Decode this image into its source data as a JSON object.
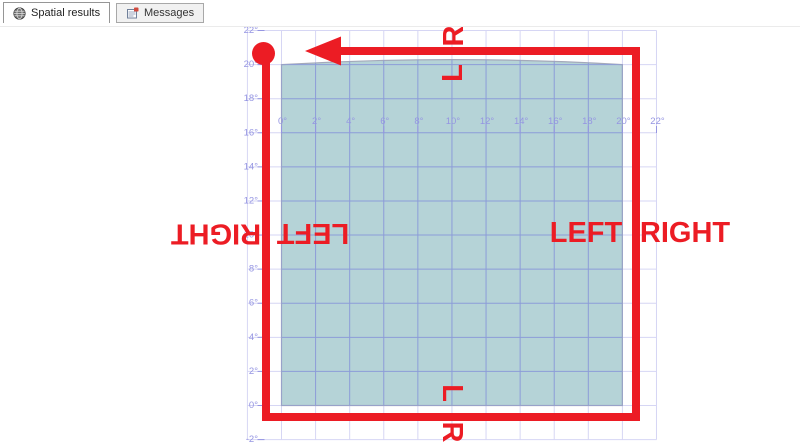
{
  "tabs": [
    {
      "label": "Spatial results",
      "icon": "globe-icon",
      "active": true
    },
    {
      "label": "Messages",
      "icon": "messages-icon",
      "active": false
    }
  ],
  "chart_data": {
    "type": "spatial-map",
    "title": "Spatial results grid with geography polygon ring and red direction annotations",
    "x_axis": {
      "labels": [
        "0°",
        "2°",
        "4°",
        "6°",
        "8°",
        "10°",
        "12°",
        "14°",
        "16°",
        "18°",
        "20°",
        "22°"
      ],
      "values": [
        0,
        2,
        4,
        6,
        8,
        10,
        12,
        14,
        16,
        18,
        20,
        22
      ]
    },
    "y_axis": {
      "labels": [
        "22°",
        "20°",
        "18°",
        "16°",
        "14°",
        "12°",
        "10°",
        "8°",
        "6°",
        "4°",
        "2°",
        "0°",
        "-2°"
      ],
      "values": [
        22,
        20,
        18,
        16,
        14,
        12,
        10,
        8,
        6,
        4,
        2,
        0,
        -2
      ]
    },
    "grid": {
      "on": true,
      "step_deg": 2,
      "range_deg": [
        -2,
        22
      ],
      "color_outside": "#d6d6f4",
      "color_inside": "#8c9cd8"
    },
    "axis_label_color": "#9595e2",
    "polygon": {
      "x_range_deg": [
        0,
        20
      ],
      "y_range_deg": [
        0,
        20
      ],
      "fill": "#b5d3d7",
      "stroke": "#a4a9ba",
      "top_edge": "slight upward arc"
    },
    "annotations": {
      "color": "#ec1c24",
      "direction": "counterclockwise ring, arrow points west along top edge",
      "labels": {
        "top_outside": "R",
        "top_inside": "L",
        "left_outside": "RIGHT",
        "left_inside": "LEFT",
        "right_inside": "LEFT",
        "right_outside": "RIGHT",
        "bottom_inside": "L",
        "bottom_outside": "R"
      }
    }
  }
}
